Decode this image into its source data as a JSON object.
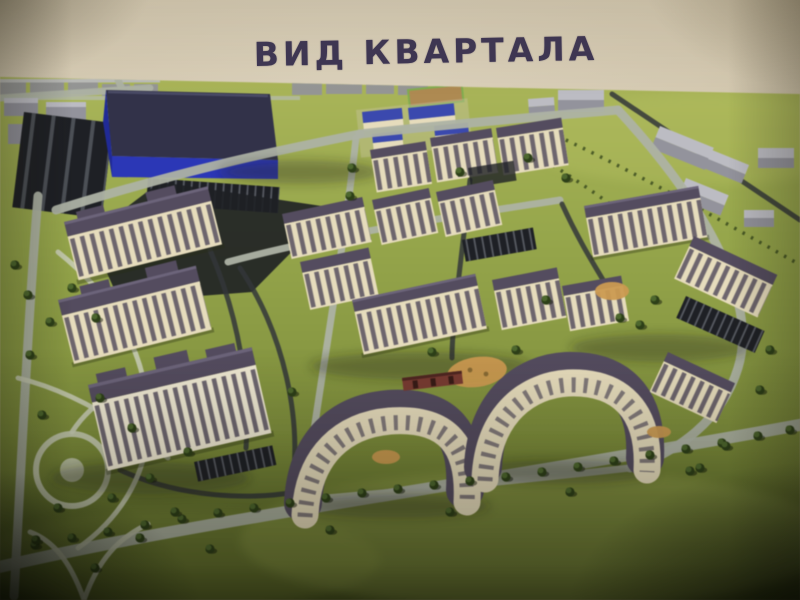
{
  "title": {
    "text": "ВИД КВАРТАЛА"
  },
  "colors": {
    "ink": "#3e3654",
    "paper": "#d6ccb6",
    "grass": "#96a845",
    "grass-light": "#b3c259",
    "grass-dark": "#4a5a1d",
    "road": "#adb2a3",
    "road-dark": "#33363a",
    "asphalt": "#1e2025",
    "path": "#c7cbb1",
    "roof": "#544c60",
    "roof-ridge": "#807892",
    "wall": "#e7dcba",
    "wall-light": "#efe8d0",
    "window": "#57505f",
    "brick": "#7c3a30",
    "blue-roof": "#32324b",
    "blue-wall": "#2a36bf",
    "school-roof": "#3a49b5",
    "sport-field": "#7fae4a",
    "sand": "#b08a4e",
    "tree": "#2c4016",
    "tree-light": "#4c682a",
    "playground": "#cf9a4b",
    "context": "#93939d",
    "context-roof": "#bcbcc4",
    "shadow": "#272d12",
    "stripe": "#585c64"
  },
  "scene": {
    "labels": [
      "industrial-building",
      "striped-parking-lot",
      "school-campus",
      "sports-field",
      "residential-towers",
      "perimeter-apartment-blocks",
      "courtyard-playgrounds",
      "park-with-paths",
      "tree-lined-boulevard",
      "context-buildings",
      "road-network"
    ]
  }
}
